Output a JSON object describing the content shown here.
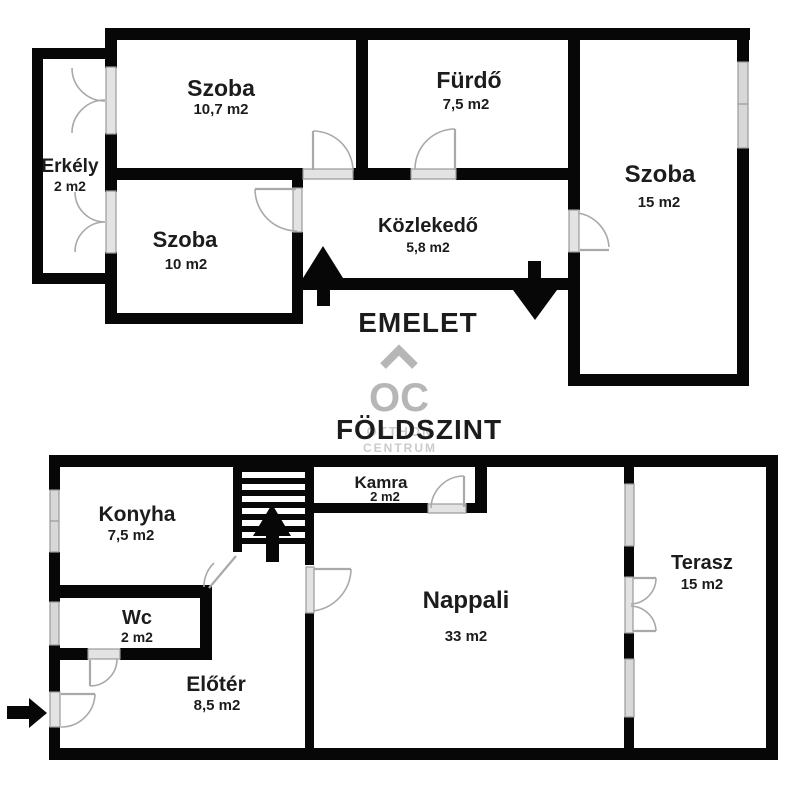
{
  "floors": [
    {
      "label": "EMELET",
      "rooms": [
        {
          "name": "szoba-1",
          "label": "Szoba",
          "area": "10,7 m2"
        },
        {
          "name": "furdo",
          "label": "Fürdő",
          "area": "7,5 m2"
        },
        {
          "name": "szoba-2",
          "label": "Szoba",
          "area": "15 m2"
        },
        {
          "name": "erkely",
          "label": "Erkély",
          "area": "2 m2"
        },
        {
          "name": "szoba-3",
          "label": "Szoba",
          "area": "10 m2"
        },
        {
          "name": "kozlekedo",
          "label": "Közlekedő",
          "area": "5,8 m2"
        }
      ]
    },
    {
      "label": "FÖLDSZINT",
      "rooms": [
        {
          "name": "konyha",
          "label": "Konyha",
          "area": "7,5 m2"
        },
        {
          "name": "kamra",
          "label": "Kamra",
          "area": "2 m2"
        },
        {
          "name": "nappali",
          "label": "Nappali",
          "area": "33 m2"
        },
        {
          "name": "terasz",
          "label": "Terasz",
          "area": "15 m2"
        },
        {
          "name": "wc",
          "label": "Wc",
          "area": "2 m2"
        },
        {
          "name": "eloter",
          "label": "Előtér",
          "area": "8,5 m2"
        }
      ]
    }
  ],
  "watermark": {
    "logo": "OC",
    "line1": "OTTHON",
    "line2": "CENTRUM"
  },
  "colors": {
    "wall": "#070707",
    "window_fill": "#d8d8d8",
    "window_stroke": "#9a9a9a",
    "door_stroke": "#a9a9a9",
    "sill_fill": "#e3e3e3",
    "watermark": "#b6b6b6",
    "watermark_light": "#cbcbcb",
    "text": "#1c1c1c",
    "bg": "#ffffff"
  }
}
